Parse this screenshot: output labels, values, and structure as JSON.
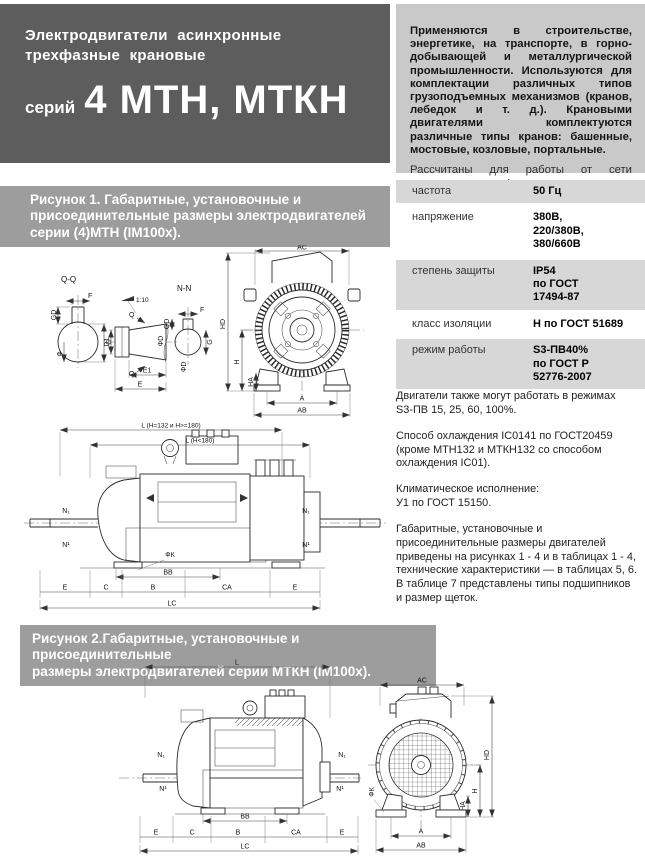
{
  "header": {
    "title": "Электродвигатели асинхронные\nтрехфазные крановые",
    "series_prefix": "серий",
    "series_name": "4 МТН, МТКН"
  },
  "intro": {
    "body": "Применяются в строительстве, энергетике, на транспорте, в горно-добывающей и металлургической промышленности. Используются для комплектации различных типов грузоподъемных механизмов (кранов, лебедок и т. д.). Крановыми двигателями комплектуются различные типы кранов: башенные, мостовые, козловые, портальные.",
    "note": "Рассчитаны для работы от сети переменного трехфазного тока."
  },
  "table": {
    "rows": [
      {
        "label": "частота",
        "value": "50 Гц"
      },
      {
        "label": "напряжение",
        "value": "380В,\n220/380В,\n380/660В"
      },
      {
        "label": "степень защиты",
        "value": "IP54\nпо ГОСТ\n17494-87"
      },
      {
        "label": "класс изоляции",
        "value": "Н по ГОСТ 51689"
      },
      {
        "label": "режим работы",
        "value": "S3-ПВ40%\nпо ГОСТ Р\n52776-2007"
      }
    ]
  },
  "notes": [
    "Двигатели также могут работать в режимах\n S3-ПВ 15, 25, 60, 100%.",
    "Способ охлаждения IC0141 по ГОСТ20459 (кроме МТН132 и МТКН132 со способом охлаждения IC01).",
    "Климатическое исполнение:\nУ1 по ГОСТ 15150.",
    "Габаритные, установочные и присоединительные размеры двигателей приведены на рисунках 1 - 4 и в таблицах 1 - 4, технические характеристики — в таблицах 5, 6.\nВ таблице 7 представлены типы подшипников и размер щеток."
  ],
  "figure1": {
    "caption": "Рисунок 1. Габаритные, установочные и\nприсоединительные размеры электродвигателей\nсерии (4)МТН (IM100х).",
    "labels": {
      "qq": "Q-Q",
      "nn": "N-N",
      "taper": "1:10",
      "q": "Q",
      "gd": "GD",
      "f": "F",
      "g": "G",
      "phi": "Ф",
      "d1": "D1",
      "phid": "ФD",
      "e1": "E1",
      "e": "E",
      "ac": "AC",
      "hd": "HD",
      "h": "H",
      "ha": "HA",
      "a": "A",
      "ab": "AB",
      "l_long": "L (H=132 и H>=180)",
      "l_short": "L (H<180)",
      "n_sub": "N₁",
      "n_sup": "N¹",
      "phik": "ФК",
      "bb": "BB",
      "c": "C",
      "b": "B",
      "ca": "CA",
      "lc": "LC"
    }
  },
  "figure2": {
    "caption": "Рисунок 2.Габаритные, установочные и присоединительные\nразмеры электродвигателей серии МТКН (IM100х).",
    "labels": {
      "l": "L",
      "n_sub": "N₁",
      "n_sup": "N¹",
      "bb": "BB",
      "e": "E",
      "c": "C",
      "b": "B",
      "ca": "CA",
      "lc": "LC",
      "ac": "AC",
      "hd": "HD",
      "h": "H",
      "ha": "HA",
      "phik": "ФК",
      "a": "A",
      "ab": "AB"
    }
  }
}
